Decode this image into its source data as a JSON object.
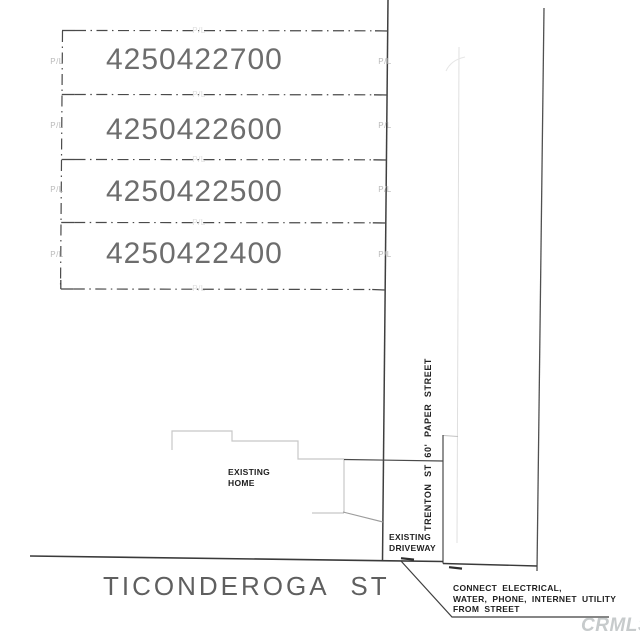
{
  "plan": {
    "parcels": [
      {
        "apn": "4250422700"
      },
      {
        "apn": "4250422600"
      },
      {
        "apn": "4250422500"
      },
      {
        "apn": "4250422400"
      }
    ],
    "property_line_label": "P/L",
    "streets": {
      "ticonderoga_label": "TICONDEROGA ST",
      "trenton_label": "TRENTON ST 60' PAPER STREET"
    },
    "annotations": {
      "home_line1": "EXISTING",
      "home_line2": "HOME",
      "driveway_line1": "EXISTING",
      "driveway_line2": "DRIVEWAY",
      "utility_line1": "CONNECT ELECTRICAL,",
      "utility_line2": "WATER, PHONE, INTERNET UTILITY",
      "utility_line3": "FROM STREET"
    },
    "watermark": "CRMLS",
    "colors": {
      "ink_dark": "#3f3f3f",
      "ink_medium": "#6d6d6d",
      "ink_light": "#c8c8c8",
      "pl_gray": "#b9b9b9",
      "pl_faint": "#dedede",
      "watermark_gray": "#c7cbcc"
    }
  }
}
